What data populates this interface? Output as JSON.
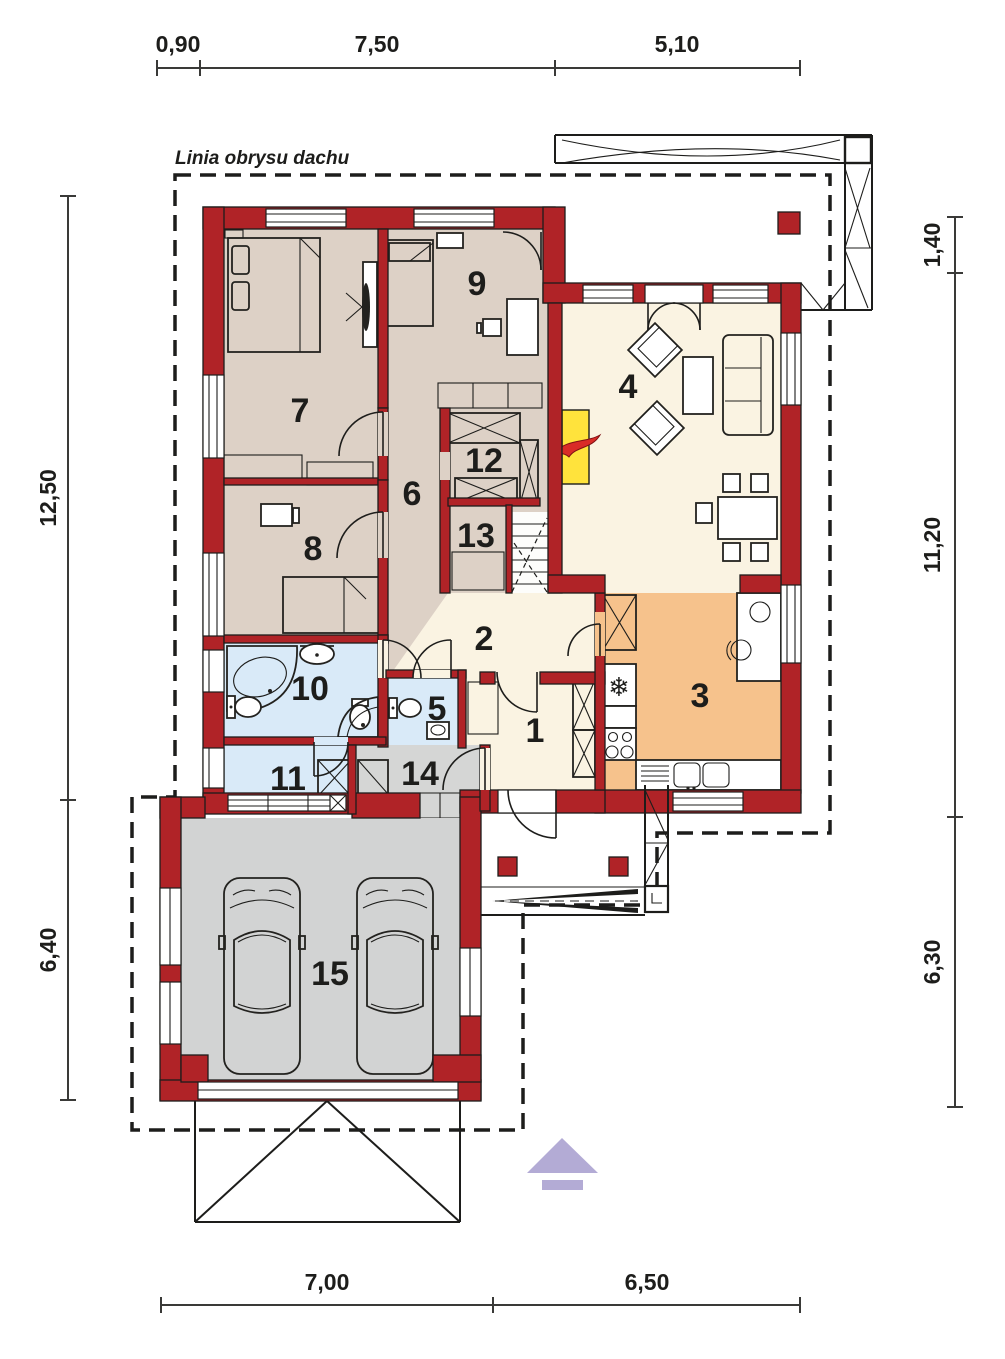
{
  "plan": {
    "roof_outline_label": "Linia obrysu dachu",
    "room_numbers": {
      "r1": "1",
      "r2": "2",
      "r3": "3",
      "r4": "4",
      "r5": "5",
      "r6": "6",
      "r7": "7",
      "r8": "8",
      "r9": "9",
      "r10": "10",
      "r11": "11",
      "r12": "12",
      "r13": "13",
      "r14": "14",
      "r15": "15"
    },
    "dimensions": {
      "top": [
        "0,90",
        "7,50",
        "5,10"
      ],
      "left": [
        "12,50",
        "6,40"
      ],
      "right": [
        "1,40",
        "11,20",
        "6,30"
      ],
      "bottom": [
        "7,00",
        "6,50"
      ]
    },
    "icons": {
      "fridge_icon": "❄"
    },
    "colors": {
      "wall_red": "#b02327",
      "room_beige": "#ddd1c6",
      "room_cream": "#faf3e2",
      "kitchen_orange": "#f6c28c",
      "bath_blue": "#d9eaf8",
      "garage_gray": "#d2d3d3",
      "fireplace_yellow": "#ffe33c",
      "flame_red": "#d92b27",
      "arrow_lavender": "#b3abd5",
      "line_black": "#1d1d1b"
    }
  }
}
